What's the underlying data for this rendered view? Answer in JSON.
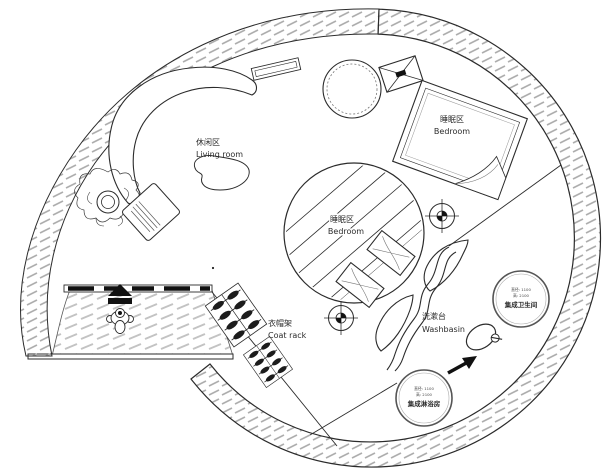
{
  "plan": {
    "type": "circular-floor-plan",
    "areas": {
      "living_room": {
        "zh": "休闲区",
        "en": "Living room"
      },
      "bedroom_right": {
        "zh": "睡眠区",
        "en": "Bedroom"
      },
      "bedroom_center": {
        "zh": "睡眠区",
        "en": "Bedroom"
      },
      "coat_rack": {
        "zh": "衣帽架",
        "en": "Coat rack"
      },
      "washbasin": {
        "zh": "洗漱台",
        "en": "Washbasin"
      }
    },
    "pods": {
      "bathroom": {
        "name": "集成卫生间",
        "spec_line1": "直径: 1100",
        "spec_line2": "高: 2100"
      },
      "shower": {
        "name": "集成淋浴房",
        "spec_line1": "直径: 1100",
        "spec_line2": "高: 2100"
      }
    },
    "colors": {
      "line": "#2b2b2b",
      "wall_hatch": "#aeaeae",
      "deck_hatch": "#c3c3c3",
      "arrow_black": "#111111"
    }
  }
}
